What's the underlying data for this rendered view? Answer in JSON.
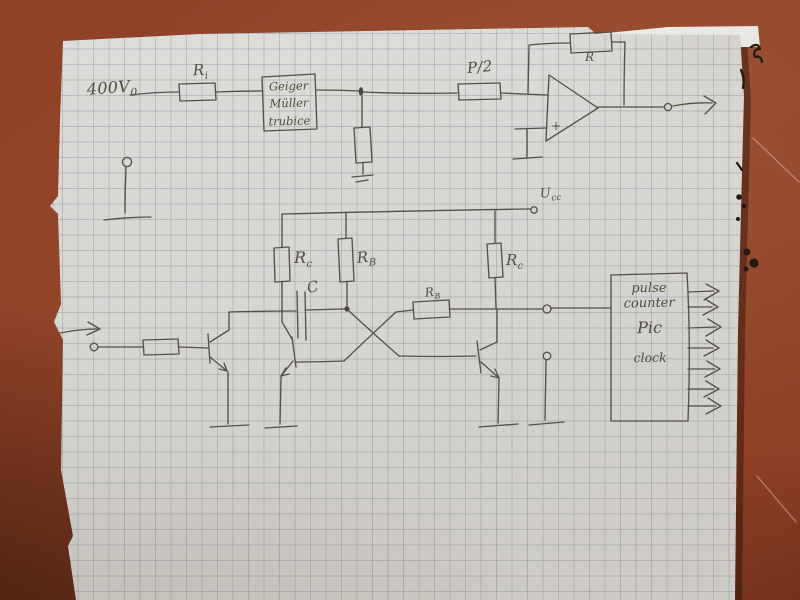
{
  "colors": {
    "table_surface": "#8f4126",
    "table_shadow_corner": "#4a1d0e",
    "paper": "#d7d6d1",
    "grid_line": "#7c8a9e",
    "pencil": "#55514a",
    "ink_marks": "#241a12"
  },
  "labels": {
    "hv": {
      "main": "400V",
      "sub": "0"
    },
    "r_input": {
      "main": "R",
      "sub": "i"
    },
    "geiger": {
      "line1": "Geiger",
      "line2": "Müller",
      "line3": "trubice"
    },
    "r_half": {
      "main": "P/2",
      "sub": ""
    },
    "r_feedback": {
      "main": "R",
      "sub": ""
    },
    "opamp_plus": "+",
    "supply": {
      "main": "U",
      "sub": "cc"
    },
    "rc_left": {
      "main": "R",
      "sub": "c"
    },
    "rb_top": {
      "main": "R",
      "sub": "B"
    },
    "rc_right": {
      "main": "R",
      "sub": "c"
    },
    "cap": {
      "main": "C",
      "sub": ""
    },
    "rb_cross": {
      "main": "R",
      "sub": "B"
    },
    "counter": {
      "line1": "pulse",
      "line2": "counter",
      "line3": "Pic",
      "line4": "clock"
    }
  }
}
